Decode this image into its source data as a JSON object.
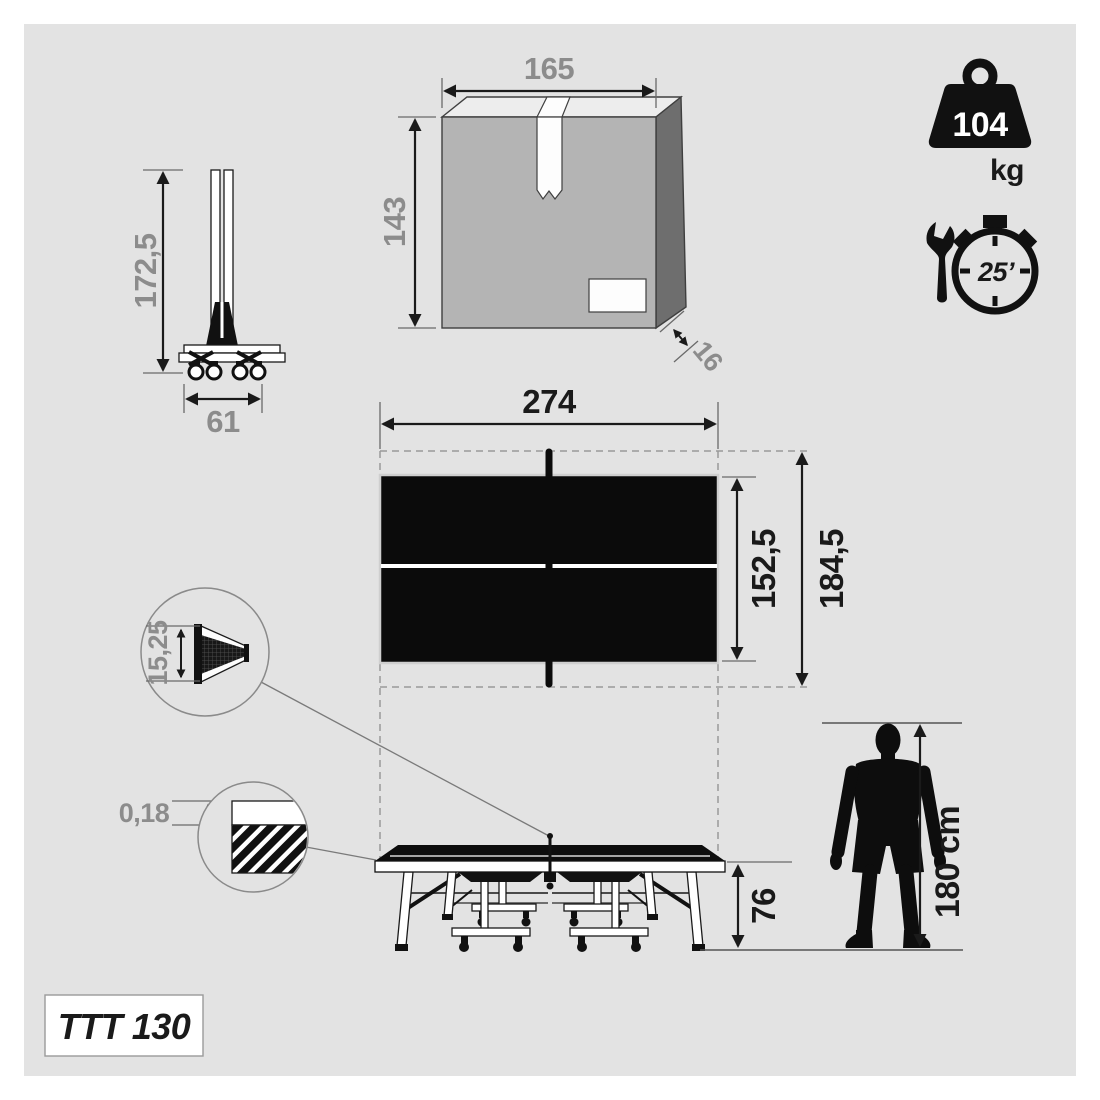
{
  "model": {
    "name": "TTT 130"
  },
  "badges": {
    "weight_value": "104",
    "weight_unit": "kg",
    "assembly_time": "25’"
  },
  "dims": {
    "folded_height": "172,5",
    "folded_width": "61",
    "box_width": "165",
    "box_height": "143",
    "box_depth": "16",
    "table_length": "274",
    "table_width": "152,5",
    "footprint_width": "184,5",
    "net_height": "15,25",
    "top_thickness": "0,18",
    "table_height": "76",
    "person_height": "180 cm"
  },
  "colors": {
    "canvas_bg": "#e3e3e3",
    "page_bg": "#ffffff",
    "ink": "#111111",
    "dim_text_gray": "#8c8c8c",
    "box_front": "#b4b4b4",
    "box_side": "#6e6e6e",
    "box_top": "#ededed",
    "dashed_line": "#9a9a9a"
  }
}
